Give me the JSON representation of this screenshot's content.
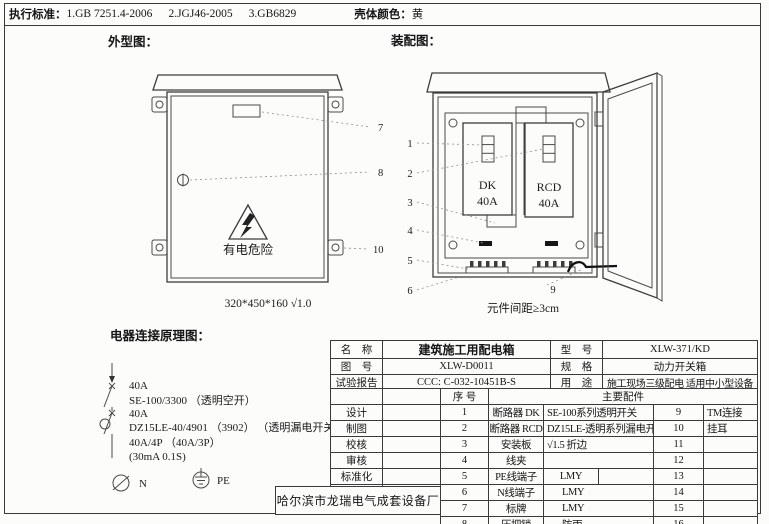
{
  "header": {
    "standards_label": "执行标准：",
    "standards": [
      "1.GB 7251.4-2006",
      "2.JGJ46-2005",
      "3.GB6829"
    ],
    "shell_label": "壳体颜色：",
    "shell_value": "黄"
  },
  "sections": {
    "outline": "外型图：",
    "assembly": "装配图：",
    "schematic": "电器连接原理图："
  },
  "outline": {
    "warning_text": "有电危险",
    "dimensions": "320*450*160 √1.0",
    "callouts": [
      "7",
      "8",
      "10"
    ]
  },
  "assembly": {
    "breaker1_name": "DK",
    "breaker1_rating": "40A",
    "breaker2_name": "RCD",
    "breaker2_rating": "40A",
    "note": "元件间距≥3cm",
    "callouts": [
      "1",
      "2",
      "3",
      "4",
      "5",
      "6",
      "9"
    ]
  },
  "schematic": {
    "lines": [
      "40A",
      "SE-100/3300 （透明空开）",
      "40A",
      "DZ15LE-40/4901 （3902） （透明漏电开关）",
      "40A/4P （40A/3P）",
      "(30mA 0.1S)"
    ],
    "n_label": "N",
    "pe_label": "PE"
  },
  "info_table": {
    "rows": [
      {
        "label": "名    称",
        "value": "建筑施工用配电箱",
        "label2": "型    号",
        "value2": "XLW-371/KD"
      },
      {
        "label": "图    号",
        "value": "XLW-D0011",
        "label2": "规    格",
        "value2": "动力开关箱"
      },
      {
        "label": "试验报告",
        "value": "CCC: C-032-10451B-S",
        "label2": "用    途",
        "value2": "施工现场三级配电 适用中小型设备"
      }
    ]
  },
  "parts_table": {
    "serial_header": "序  号",
    "main_header": "主要配件",
    "signoff_labels": [
      "设计",
      "制图",
      "校核",
      "审核",
      "标准化",
      "日期"
    ],
    "rows": [
      {
        "no": "1",
        "name": "断路器 DK",
        "spec": "SE-100系列透明开关",
        "no2": "9",
        "name2": "TM连接"
      },
      {
        "no": "2",
        "name": "断路器 RCD",
        "spec": "DZ15LE-透明系列漏电开",
        "no2": "10",
        "name2": "挂耳"
      },
      {
        "no": "3",
        "name": "安装板",
        "spec": "√1.5 折边",
        "no2": "11",
        "name2": ""
      },
      {
        "no": "4",
        "name": "线夹",
        "spec": "",
        "no2": "12",
        "name2": ""
      },
      {
        "no": "5",
        "name": "PE线端子",
        "spec": "LMY",
        "no2": "13",
        "name2": ""
      },
      {
        "no": "6",
        "name": "N线端子",
        "spec": "LMY",
        "no2": "14",
        "name2": ""
      },
      {
        "no": "7",
        "name": "标牌",
        "spec": "LMY",
        "no2": "15",
        "name2": ""
      },
      {
        "no": "8",
        "name": "压把锁",
        "spec": "防雨",
        "no2": "16",
        "name2": ""
      }
    ]
  },
  "factory_name": "哈尔滨市龙瑞电气成套设备厂"
}
